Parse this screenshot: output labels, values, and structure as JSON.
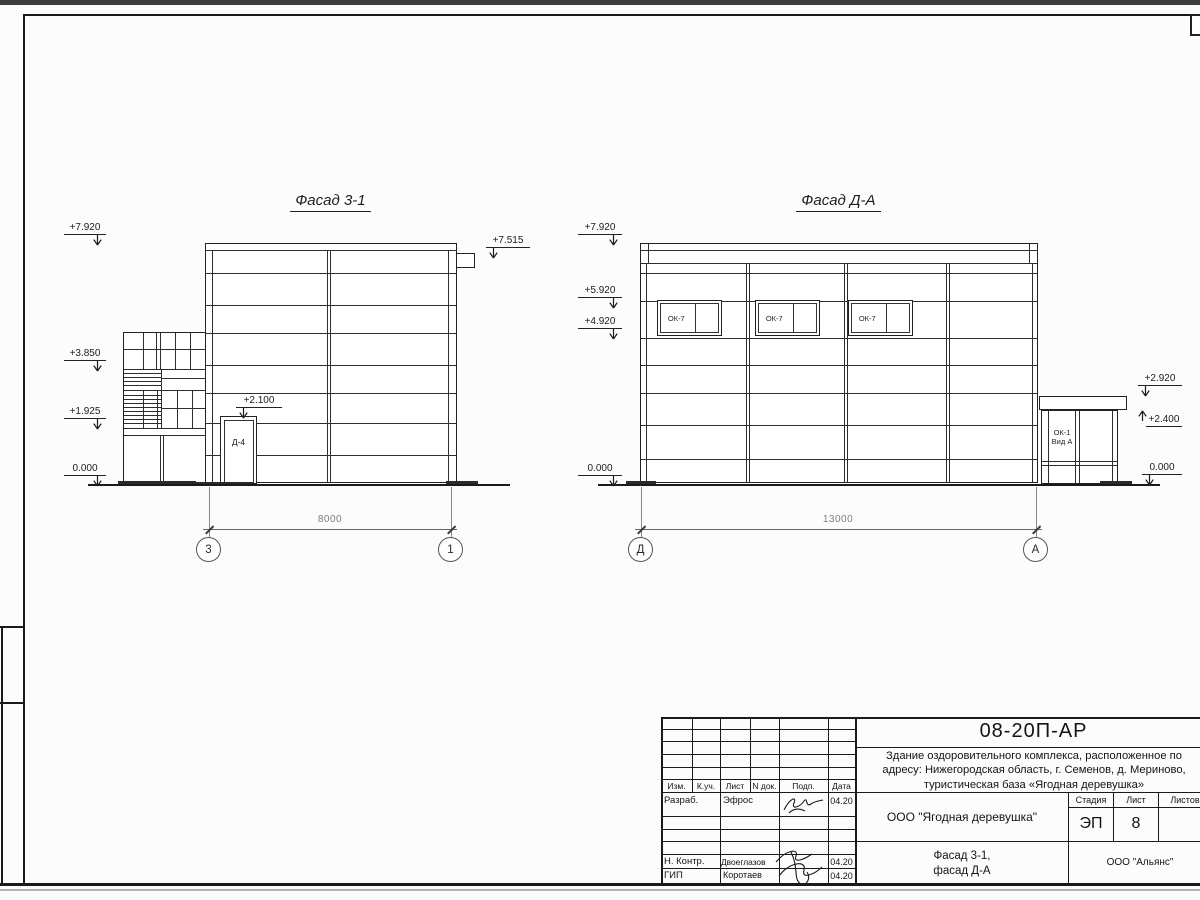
{
  "facade1": {
    "title": "Фасад 3-1",
    "levels_left": [
      "+7.920",
      "+3.850",
      "+1.925",
      "0.000"
    ],
    "level_right": "+7.515",
    "level_door": "+2.100",
    "door_label": "Д-4",
    "dim": "8000",
    "axis_left": "3",
    "axis_right": "1"
  },
  "facade2": {
    "title": "Фасад Д-А",
    "levels_left": [
      "+7.920",
      "+5.920",
      "+4.920",
      "0.000"
    ],
    "levels_right": [
      "+2.920",
      "+2.400",
      "0.000"
    ],
    "window_label": "ОК-7",
    "annex_label_1": "ОК-1",
    "annex_label_2": "Вид А",
    "dim": "13000",
    "axis_left": "Д",
    "axis_right": "А"
  },
  "titleblock": {
    "code": "08-20П-АР",
    "desc_line1": "Здание оздоровительного комплекса, расположенное по",
    "desc_line2": "адресу: Нижегородская область, г. Семенов, д. Мериново,",
    "desc_line3": "туристическая база «Ягодная деревушка»",
    "org": "ООО \"Ягодная деревушка\"",
    "subtitle_line1": "Фасад 3-1,",
    "subtitle_line2": "фасад Д-А",
    "company": "ООО \"Альянс\"",
    "stage_label": "Стадия",
    "sheet_label": "Лист",
    "sheets_label": "Листов",
    "stage": "ЭП",
    "sheet_num": "8",
    "cols": [
      "Изм.",
      "К.уч.",
      "Лист",
      "N док.",
      "Подп.",
      "Дата"
    ],
    "rows": [
      {
        "role": "Разраб.",
        "name": "Эфрос",
        "date": "04.20"
      },
      {
        "role": "Н. Контр.",
        "name": "Двоеглазов",
        "date": "04.20"
      },
      {
        "role": "ГИП",
        "name": "Коротаев",
        "date": "04.20"
      }
    ]
  }
}
